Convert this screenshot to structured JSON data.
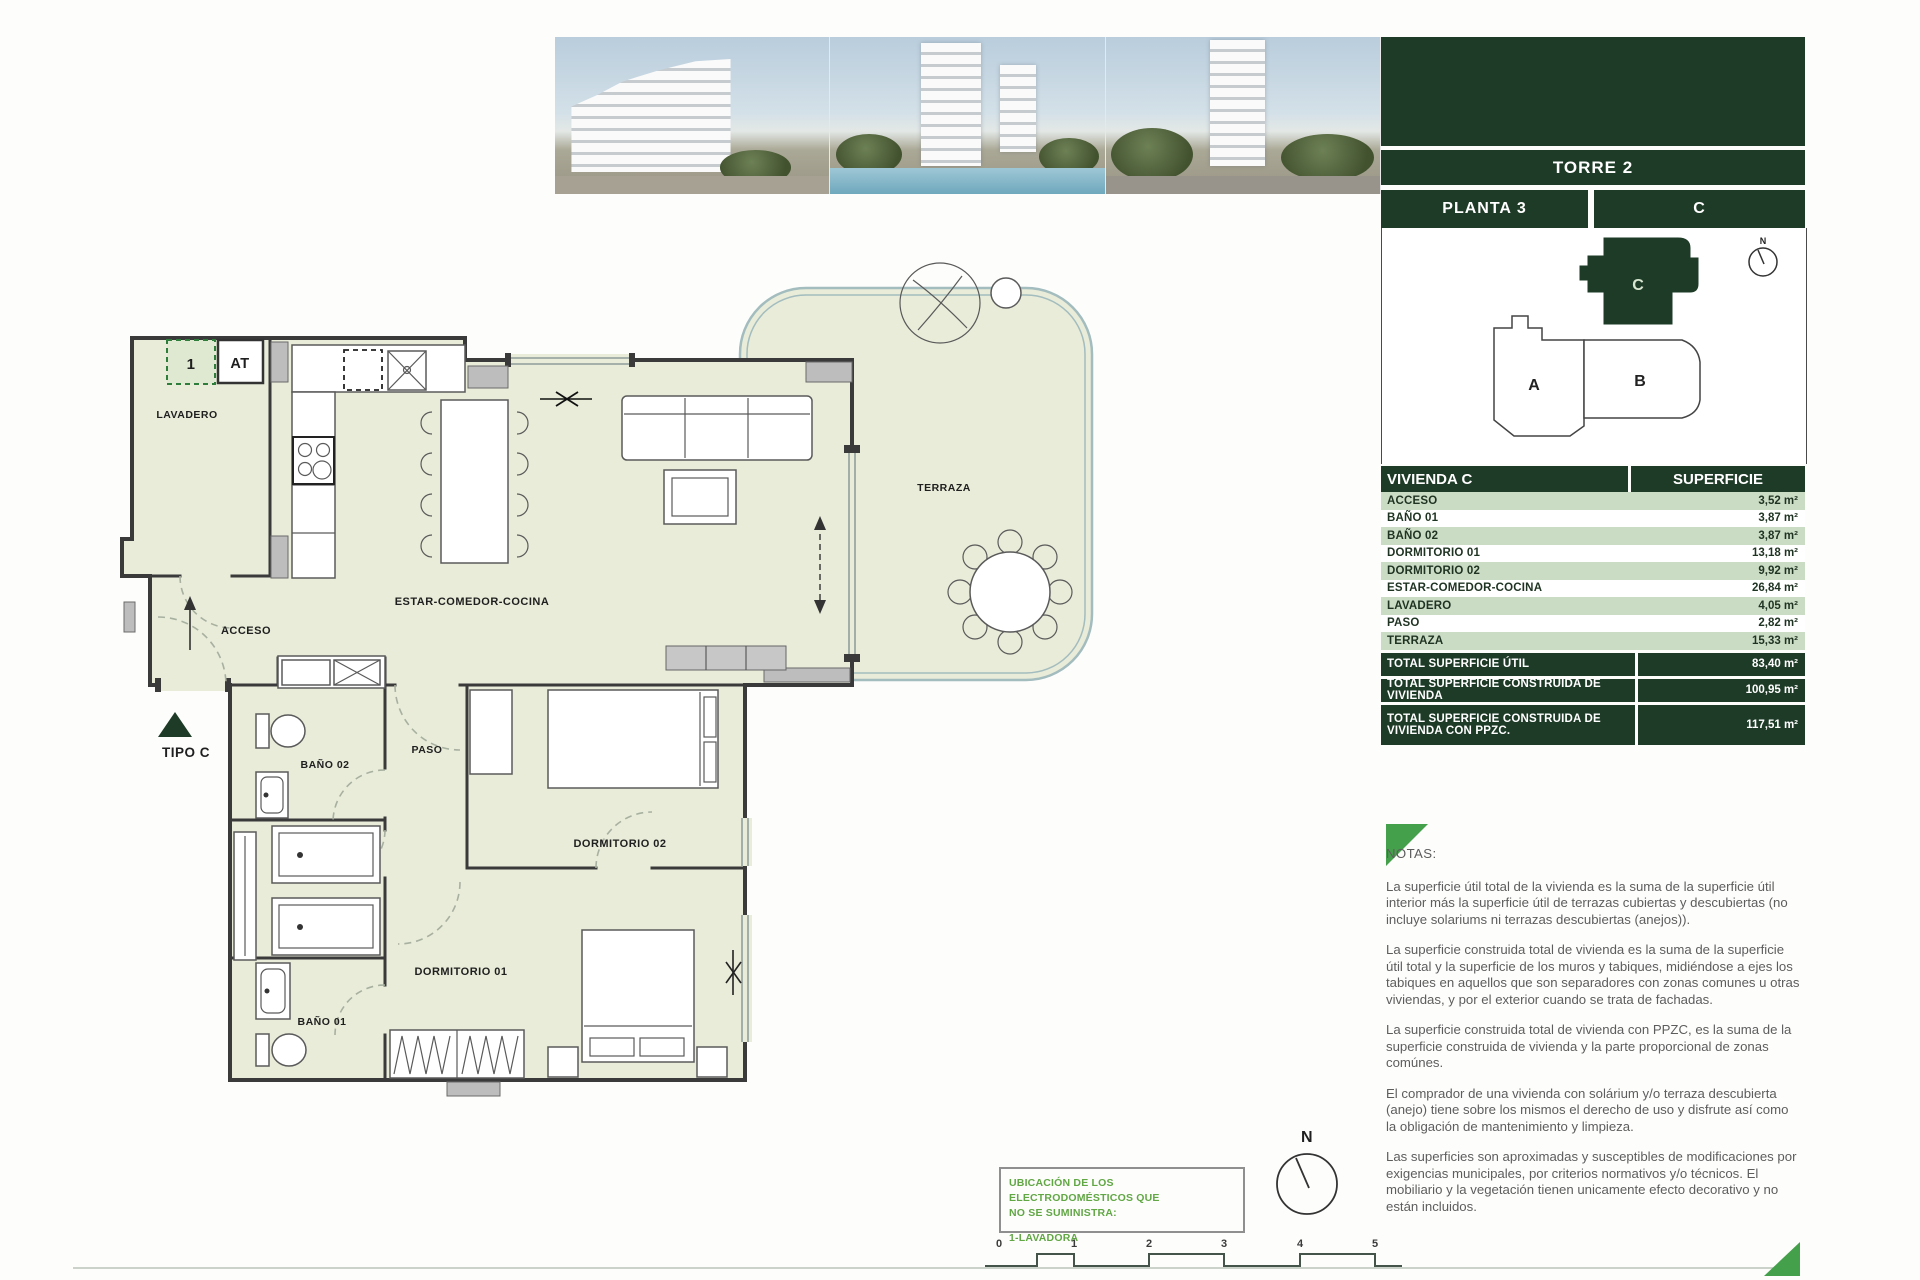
{
  "panel": {
    "torre_label": "TORRE 2",
    "planta_label": "PLANTA 3",
    "unit_label": "C",
    "keyplan": {
      "unit_a": "A",
      "unit_b": "B",
      "unit_c": "C",
      "north": "N"
    },
    "table": {
      "title": "VIVIENDA C",
      "superficie_header": "SUPERFICIE",
      "rows": [
        {
          "label": "ACCESO",
          "value": "3,52 m²"
        },
        {
          "label": "BAÑO 01",
          "value": "3,87 m²"
        },
        {
          "label": "BAÑO 02",
          "value": "3,87 m²"
        },
        {
          "label": "DORMITORIO 01",
          "value": "13,18 m²"
        },
        {
          "label": "DORMITORIO 02",
          "value": "9,92 m²"
        },
        {
          "label": "ESTAR-COMEDOR-COCINA",
          "value": "26,84 m²"
        },
        {
          "label": "LAVADERO",
          "value": "4,05 m²"
        },
        {
          "label": "PASO",
          "value": "2,82 m²"
        },
        {
          "label": "TERRAZA",
          "value": "15,33 m²"
        }
      ],
      "totals": [
        {
          "label": "TOTAL SUPERFICIE ÚTIL",
          "value": "83,40 m²"
        },
        {
          "label": "TOTAL SUPERFICIE CONSTRUIDA DE VIVIENDA",
          "value": "100,95 m²"
        },
        {
          "label": "TOTAL SUPERFICIE CONSTRUIDA DE VIVIENDA CON PPZC.",
          "value": "117,51 m²"
        }
      ]
    },
    "notas": {
      "title": "NOTAS:",
      "paragraphs": [
        "La superficie útil total de la vivienda es la suma de la superficie útil interior más la superficie útil de terrazas cubiertas y descubiertas (no incluye solariums ni terrazas descubiertas (anejos)).",
        "La superficie construida total de vivienda es la suma de la superficie útil total y la superficie de los muros y tabiques, midiéndose a ejes los tabiques en aquellos que son separadores con zonas comunes u otras viviendas, y por el exterior cuando se trata de fachadas.",
        "La superficie construida total de vivienda con PPZC, es la suma de la superficie construida de vivienda y la parte proporcional de zonas comúnes.",
        "El comprador de una vivienda con solárium y/o terraza descubierta (anejo) tiene sobre los mismos el derecho de uso y disfrute así como la obligación de mantenimiento y limpieza.",
        "Las superficies son aproximadas y susceptibles de modificaciones por exigencias municipales, por criterios normativos y/o técnicos. El mobiliario y la vegetación tienen unicamente efecto decorativo y no están incluidos."
      ]
    }
  },
  "plan": {
    "labels": {
      "lavadero": "LAVADERO",
      "acceso": "ACCESO",
      "estar": "ESTAR-COMEDOR-COCINA",
      "terraza": "TERRAZA",
      "paso": "PASO",
      "bano02": "BAÑO 02",
      "bano01": "BAÑO 01",
      "dormitorio01": "DORMITORIO 01",
      "dormitorio02": "DORMITORIO 02",
      "tipo": "TIPO C",
      "tag_1": "1",
      "tag_at": "AT",
      "north": "N"
    }
  },
  "footer": {
    "appliance_box": {
      "line1": "UBICACIÓN DE LOS ELECTRODOMÉSTICOS QUE",
      "line2": "NO SE SUMINISTRA:",
      "item": "1-LAVADORA"
    },
    "scale_ticks": [
      "0",
      "1",
      "2",
      "3",
      "4",
      "5"
    ]
  },
  "colors": {
    "dark_green": "#1e3b27",
    "row_green": "#cbdcc5",
    "accent_green": "#44a04a",
    "floor": "#e8ecd9",
    "terrace_line": "#a3bcbe"
  }
}
